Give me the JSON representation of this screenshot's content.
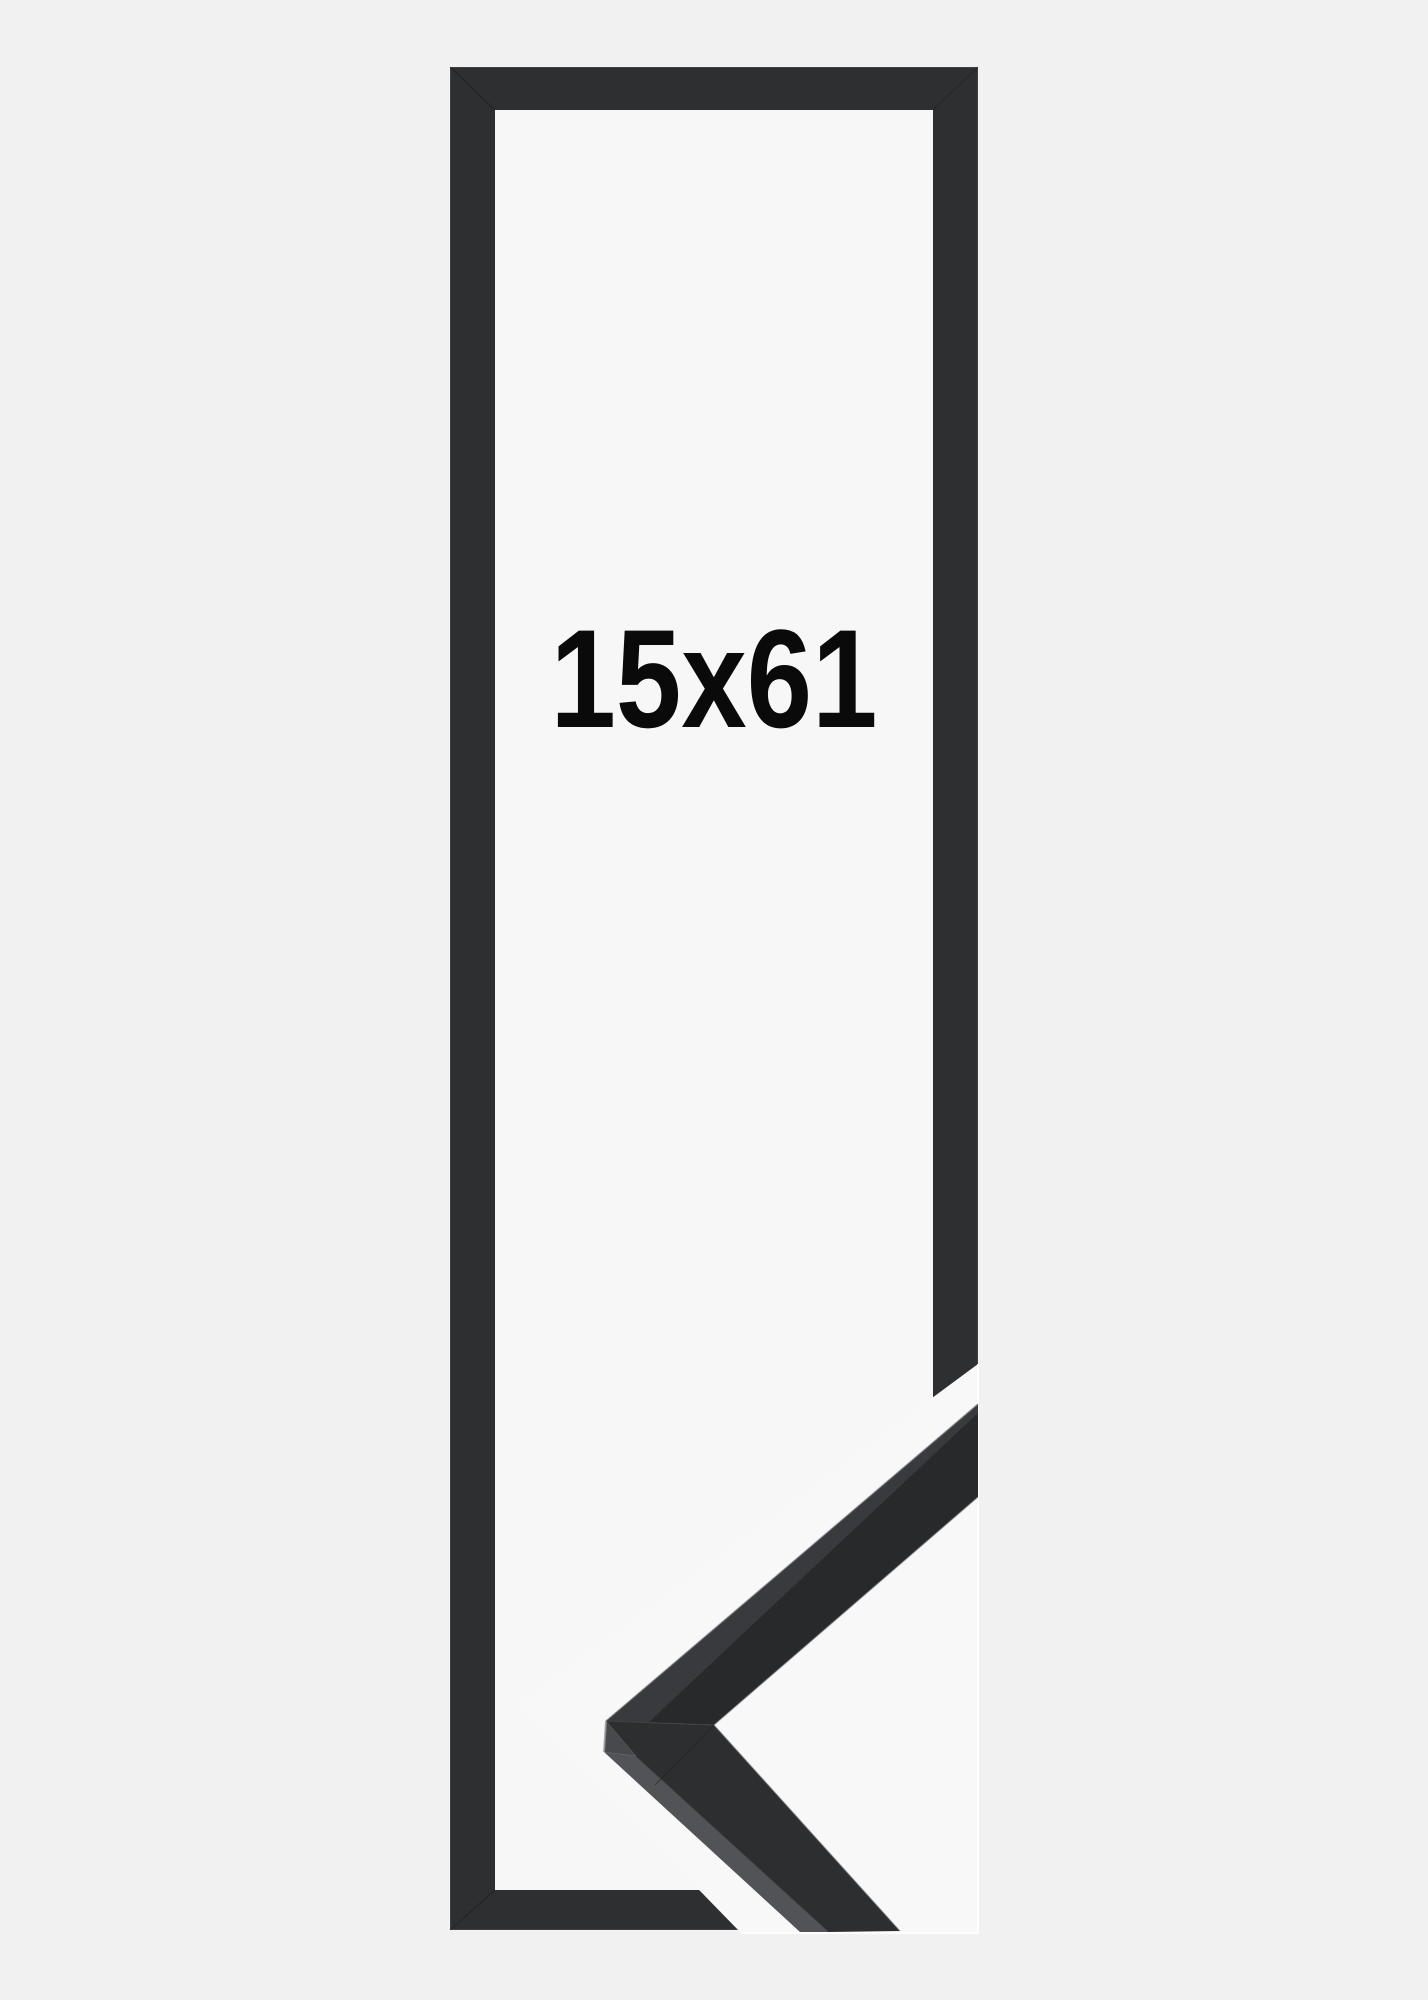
{
  "page": {
    "background_color": "#f1f1f2"
  },
  "product_image": {
    "size_label": "15x61",
    "label_color": "#0a0a0b",
    "frame_color": "#2e2f31",
    "frame_inner_background": "#f7f7f8",
    "corner_photo_background": "#f8f8f9",
    "corner_upper_face_color": "#28292b",
    "corner_lower_face_color": "#2d2e30",
    "corner_top_edge_color": "#383a3d",
    "corner_side_facet_color": "#515357",
    "corner_apex_facet_color": "#47494d"
  }
}
